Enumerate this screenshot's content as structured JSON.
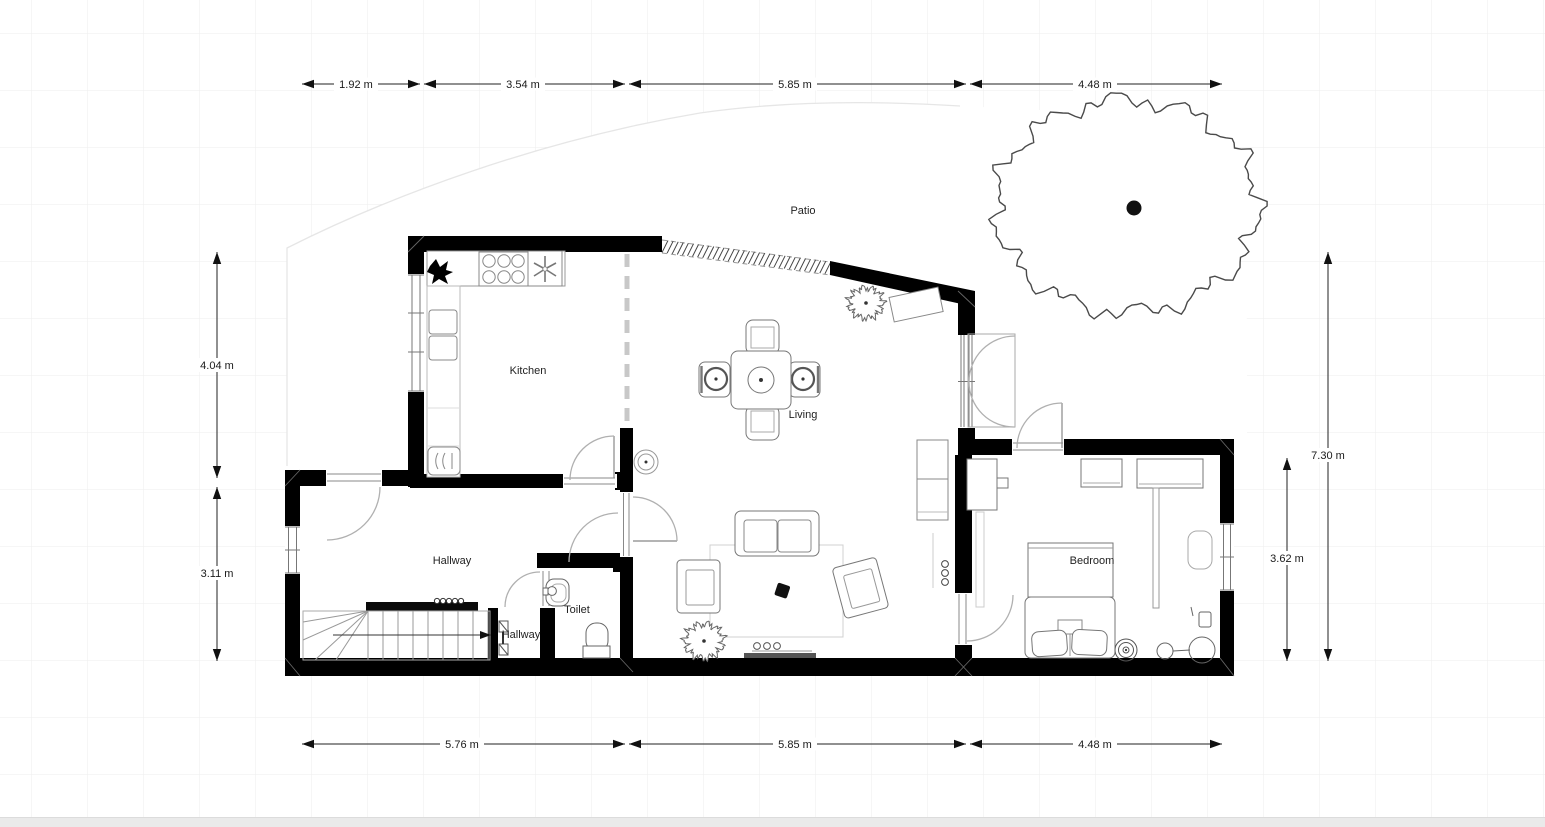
{
  "canvas": {
    "background": "#ffffff",
    "grid_color": "#ededed",
    "wall_color": "#000000",
    "footer_strip_color": "#eaeaea",
    "arc_color": "#b0b0b0"
  },
  "rooms": {
    "patio": "Patio",
    "kitchen": "Kitchen",
    "living": "Living",
    "hallway": "Hallway",
    "hallway_lower": "Hallway",
    "toilet": "Toilet",
    "bedroom": "Bedroom"
  },
  "dimensions": {
    "top": [
      {
        "label": "1.92 m"
      },
      {
        "label": "3.54 m"
      },
      {
        "label": "5.85 m"
      },
      {
        "label": "4.48 m"
      }
    ],
    "bottom": [
      {
        "label": "5.76 m"
      },
      {
        "label": "5.85 m"
      },
      {
        "label": "4.48 m"
      }
    ],
    "left": [
      {
        "label": "4.04 m"
      },
      {
        "label": "3.11 m"
      }
    ],
    "right": [
      {
        "label": "7.30 m"
      },
      {
        "label": "3.62 m"
      }
    ]
  },
  "objects": {
    "tree": "tree",
    "patio_shrub": "shrub",
    "living_plant": "plant",
    "dining_table": "dining-table",
    "sofa": "sofa",
    "armchairs": "armchairs",
    "tv": "tv-console",
    "bed": "double-bed",
    "stairs": "stairs",
    "toilet_fixture": "toilet",
    "basin": "basin",
    "hob": "cooktop",
    "oven": "oven",
    "sink": "kitchen-sink"
  }
}
